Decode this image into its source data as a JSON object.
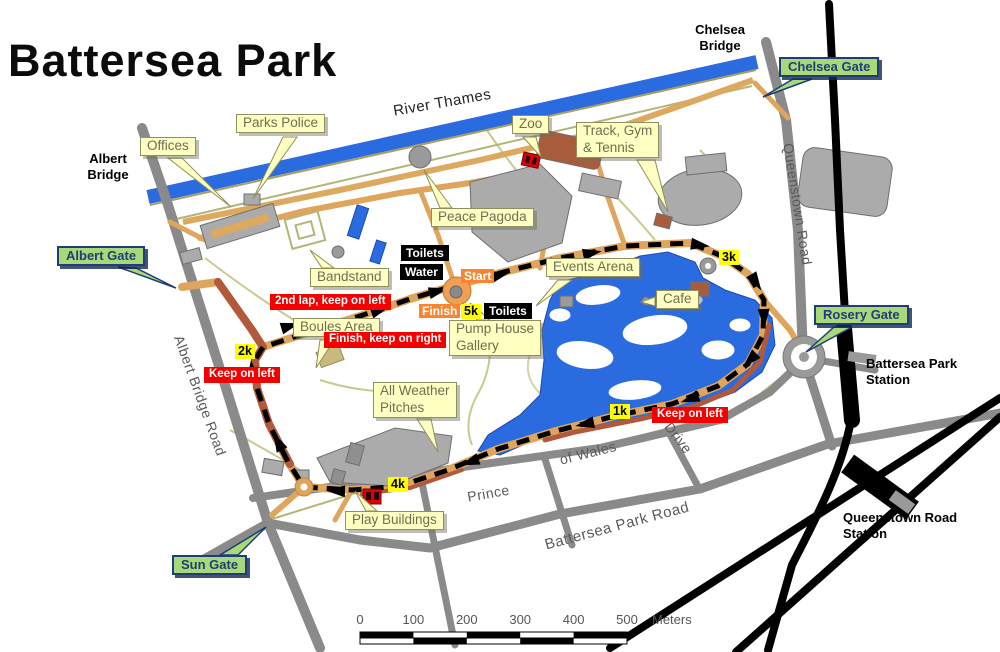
{
  "title": "Battersea Park",
  "colors": {
    "river_blue": "#2B6BE0",
    "road_grey": "#8A8A8A",
    "railway_black": "#000000",
    "path_tan": "#E0A55C",
    "drive_brown": "#B2593B",
    "place_label_yellow": "#FFFFC2",
    "gate_green": "#A8D878",
    "gate_navy": "#1F3D7A",
    "km_marker_yellow": "#FFFF00",
    "instruction_red": "#F50000",
    "start_finish_orange": "#FB8332",
    "building_grey": "#ABABAB"
  },
  "bridges": [
    {
      "label": "Chelsea\nBridge"
    },
    {
      "label": "Albert\nBridge"
    }
  ],
  "gates": [
    {
      "label": "Chelsea Gate"
    },
    {
      "label": "Albert Gate"
    },
    {
      "label": "Rosery Gate"
    },
    {
      "label": "Sun Gate"
    }
  ],
  "places": [
    {
      "label": "Offices"
    },
    {
      "label": "Parks Police"
    },
    {
      "label": "Zoo"
    },
    {
      "label": "Track, Gym\n& Tennis"
    },
    {
      "label": "Peace Pagoda"
    },
    {
      "label": "Bandstand"
    },
    {
      "label": "Events Arena"
    },
    {
      "label": "Cafe"
    },
    {
      "label": "Boules Area"
    },
    {
      "label": "Pump House\nGallery"
    },
    {
      "label": "All Weather\nPitches"
    },
    {
      "label": "Play Buildings"
    }
  ],
  "facilities": [
    {
      "label": "Toilets"
    },
    {
      "label": "Water"
    },
    {
      "label": "Toilets"
    }
  ],
  "route": {
    "start": "Start",
    "finish": "Finish",
    "km_markers": [
      {
        "label": "1k"
      },
      {
        "label": "2k"
      },
      {
        "label": "3k"
      },
      {
        "label": "4k"
      },
      {
        "label": "5k"
      }
    ],
    "instructions": [
      {
        "label": "2nd lap, keep on left"
      },
      {
        "label": "Finish, keep on right"
      },
      {
        "label": "Keep on left"
      },
      {
        "label": "Keep on left"
      }
    ]
  },
  "roads": [
    {
      "label": "River Thames"
    },
    {
      "label": "Queenstown Road"
    },
    {
      "label": "Albert Bridge Road"
    },
    {
      "label": "Prince"
    },
    {
      "label": "of Wales"
    },
    {
      "label": "Drive"
    },
    {
      "label": "Battersea Park Road"
    }
  ],
  "stations": [
    {
      "label": "Battersea Park\nStation"
    },
    {
      "label": "Queenstown Road\nStation"
    }
  ],
  "scale_bar": {
    "ticks": [
      "0",
      "100",
      "200",
      "300",
      "400",
      "500"
    ],
    "unit": "Meters"
  }
}
